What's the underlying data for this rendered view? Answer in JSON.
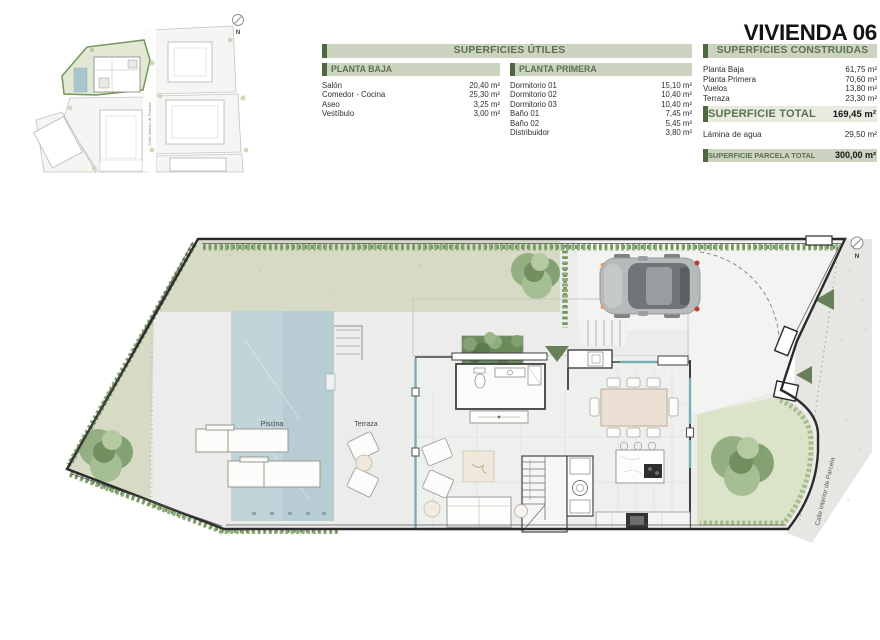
{
  "title": "VIVIENDA 06",
  "tables": {
    "utiles": {
      "header": "SUPERFICIES ÚTILES",
      "planta_baja": {
        "header": "PLANTA BAJA",
        "rows": [
          {
            "label": "Salón",
            "value": "20,40 m²"
          },
          {
            "label": "Comedor - Cocina",
            "value": "25,30 m²"
          },
          {
            "label": "Aseo",
            "value": "3,25 m²"
          },
          {
            "label": "Vestíbulo",
            "value": "3,00 m²"
          }
        ]
      },
      "planta_primera": {
        "header": "PLANTA PRIMERA",
        "rows": [
          {
            "label": "Dormitorio 01",
            "value": "15,10 m²"
          },
          {
            "label": "Dormitorio 02",
            "value": "10,40 m²"
          },
          {
            "label": "Dormitorio 03",
            "value": "10,40 m²"
          },
          {
            "label": "Baño 01",
            "value": "7,45 m²"
          },
          {
            "label": "Baño 02",
            "value": "5,45 m²"
          },
          {
            "label": "Distribuidor",
            "value": "3,80 m²"
          }
        ]
      }
    },
    "construidas": {
      "header": "SUPERFICIES CONSTRUIDAS",
      "rows": [
        {
          "label": "Planta Baja",
          "value": "61,75 m²"
        },
        {
          "label": "Planta Primera",
          "value": "70,60 m²"
        },
        {
          "label": "Vuelos",
          "value": "13,80 m²"
        },
        {
          "label": "Terraza",
          "value": "23,30 m²"
        }
      ],
      "total": {
        "label": "SUPERFICIE TOTAL",
        "value": "169,45 m²"
      },
      "lamina": {
        "label": "Lámina de agua",
        "value": "29,50 m²"
      },
      "parcela": {
        "label": "SUPERFICIE PARCELA TOTAL",
        "value": "300,00 m²"
      }
    }
  },
  "plan": {
    "pool_label": "Piscina",
    "terrace_label": "Terraza",
    "street_label": "Calle Interior de Parcela",
    "north_label": "N"
  },
  "site_plan": {
    "street_label": "Calle Interior de Parcela",
    "north_label": "N"
  },
  "colors": {
    "accent_green_dark": "#50683f",
    "accent_green_text": "#5b7150",
    "header_bar": "#ccd3c0",
    "hedge_green": "#8fac7c",
    "pool_blue": "#c0d4d9",
    "lawn": "#d7dac4",
    "marker_green": "#687f58",
    "boundary": "#2b2b2b"
  }
}
